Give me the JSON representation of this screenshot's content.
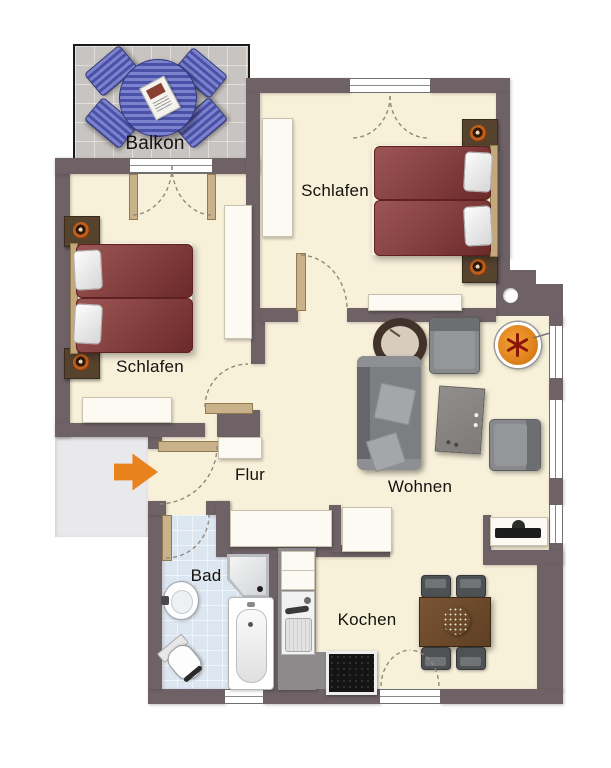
{
  "floorplan": {
    "type": "apartment-floor-plan",
    "rooms": {
      "balcony": {
        "label": "Balkon"
      },
      "bedroom_top": {
        "label": "Schlafen"
      },
      "bedroom_left": {
        "label": "Schlafen"
      },
      "hall": {
        "label": "Flur"
      },
      "living_room": {
        "label": "Wohnen"
      },
      "bathroom": {
        "label": "Bad"
      },
      "kitchen": {
        "label": "Kochen"
      }
    },
    "entrance": {
      "marker": "arrow",
      "direction": "right"
    },
    "furniture": {
      "balcony": [
        "round-table",
        "four-chairs",
        "magazine"
      ],
      "bedroom_top": [
        "double-bed",
        "nightstand-lamp-left",
        "nightstand-lamp-right",
        "wardrobe",
        "sideboard"
      ],
      "bedroom_left": [
        "double-bed",
        "nightstand-lamp-top",
        "nightstand-lamp-bottom",
        "wardrobe",
        "sideboard"
      ],
      "living_room": [
        "sofa",
        "armchair-top",
        "armchair-right",
        "coffee-table",
        "floor-vase",
        "hanging-orange-seat",
        "tv-lowboard"
      ],
      "kitchen": [
        "fridge-cabinet",
        "sink-unit",
        "cooktop",
        "counter",
        "dining-table",
        "four-chairs",
        "table-plant"
      ],
      "bathroom": [
        "shower",
        "bathtub",
        "washbasin",
        "toilet"
      ],
      "hall": [
        "closet-row",
        "closet-small",
        "closet-top"
      ]
    },
    "colors": {
      "wall": "#6e6266",
      "floor": "#f8f1da",
      "bath_floor": "#dce6f0",
      "balcony_floor": "#c8c4c1",
      "landing": "#e9e9ec",
      "bed_red": "#8a3535",
      "headboard_wood": "#c4a87c",
      "door_wood": "#c9b289",
      "sofa_gray": "#7c7e81",
      "chair_gray": "#87898c",
      "cushion_gray": "#a4a6a9",
      "table_wood": "#6b4a2c",
      "counter_gray": "#8d8a8c",
      "balcony_blue": "#4a51a8",
      "balcony_blue_light": "#7c82cc",
      "arrow_orange": "#e8821c",
      "lamp_orange": "#c05e1e",
      "hang_orange": "#e2861f",
      "plant_green": "#4f6b2c",
      "white_furniture": "#fcfaf3"
    }
  }
}
